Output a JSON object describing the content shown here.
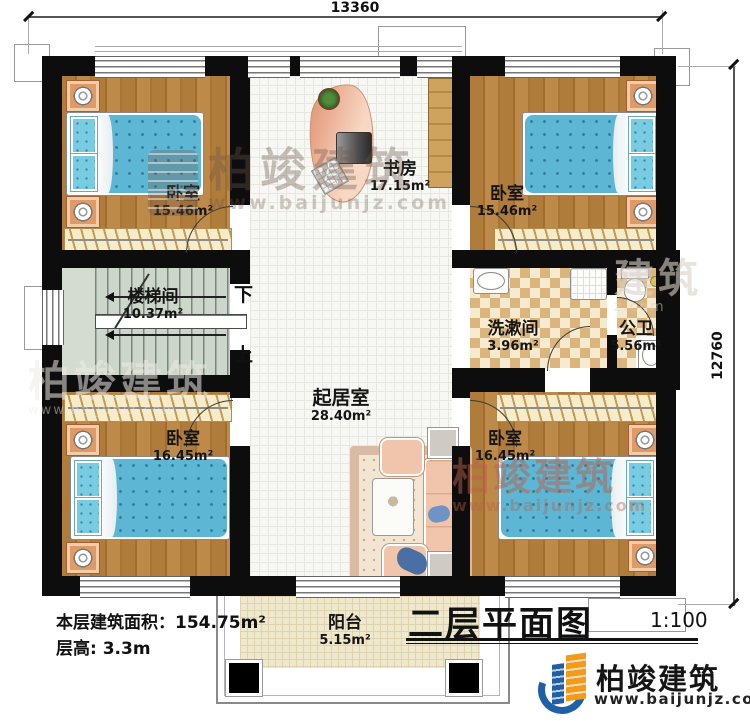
{
  "dimensions": {
    "top": "13360",
    "right": "12760"
  },
  "rooms": {
    "bedroom_tl": {
      "name": "卧室",
      "area": "15.46m²"
    },
    "study": {
      "name": "书房",
      "area": "17.15m²"
    },
    "bedroom_tr": {
      "name": "卧室",
      "area": "15.46m²"
    },
    "stairwell": {
      "name": "楼梯间",
      "area": "10.37m²"
    },
    "washroom": {
      "name": "洗漱间",
      "area": "3.96m²"
    },
    "bathroom": {
      "name": "公卫",
      "area": "5.56m²"
    },
    "living": {
      "name": "起居室",
      "area": "28.40m²"
    },
    "bedroom_bl": {
      "name": "卧室",
      "area": "16.45m²"
    },
    "bedroom_br": {
      "name": "卧室",
      "area": "16.45m²"
    },
    "balcony": {
      "name": "阳台",
      "area": "5.15m²"
    }
  },
  "stairs": {
    "down": "下",
    "up": "上"
  },
  "notes": {
    "floor_area": "本层建筑面积：154.75m²",
    "floor_height": "层高: 3.3m"
  },
  "title_block": {
    "title": "二层平面图",
    "scale": "1:100"
  },
  "brand": {
    "name": "柏竣建筑",
    "url": "www.baijunjz.com"
  },
  "watermark": {
    "name": "柏竣建筑",
    "url": "www.baijunjz.com",
    "partial_name": "建筑",
    "partial_url": "z.com"
  },
  "colors": {
    "wall": "#0d0d0d",
    "wood": "#b07c3c",
    "bed": "#5cb6d4",
    "checker": "#dcb57c",
    "brand_blue": "#1f5fa8",
    "brand_orange": "#f29b1d"
  }
}
